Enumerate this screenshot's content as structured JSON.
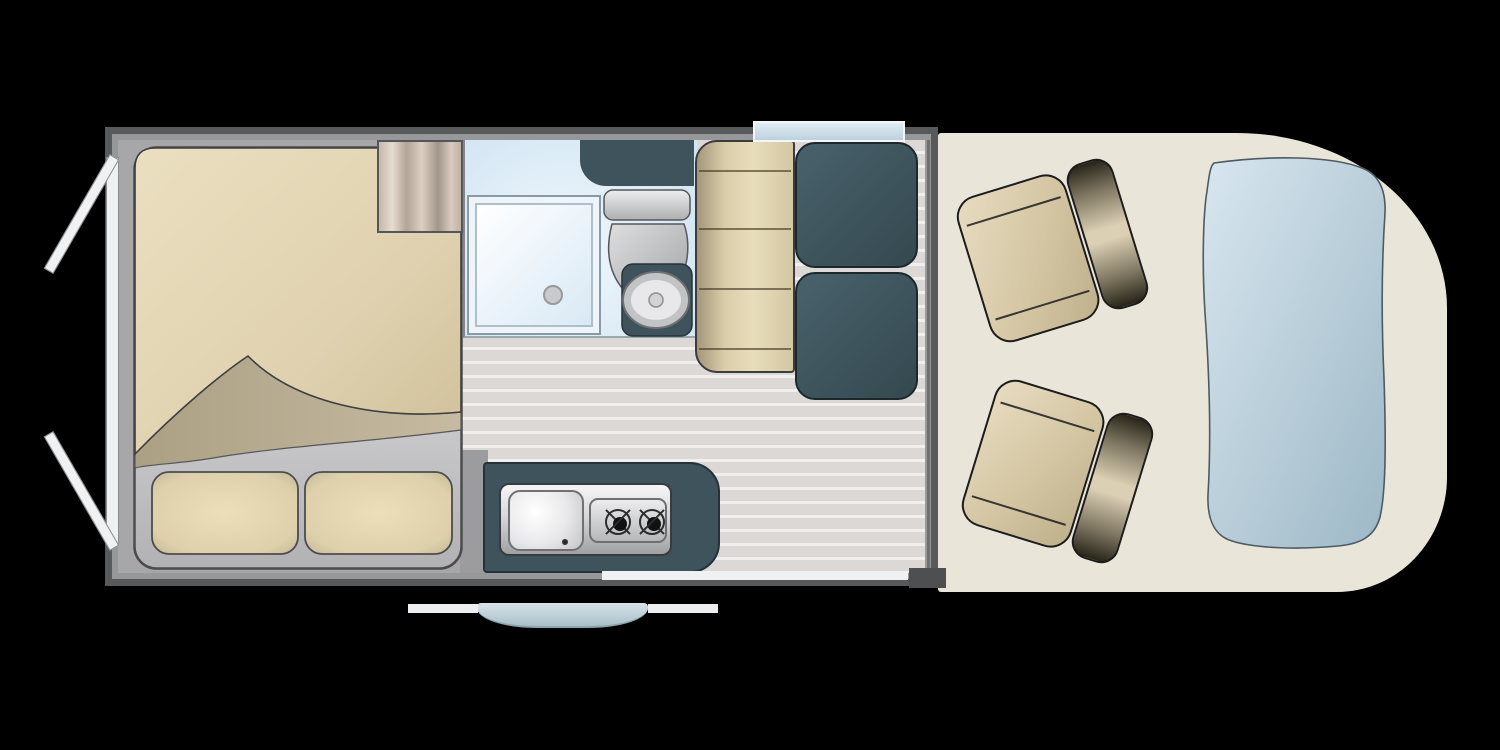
{
  "title": "Campervan floor plan (top view)",
  "palette": {
    "bg": "#000000",
    "wall_dark": "#58595b",
    "wall_light": "#97989a",
    "bedroom_floor": "#a7a7a9",
    "plank_floor": "#dcd8d6",
    "plank_line": "#f1efee",
    "cab_floor": "#e9e6d9",
    "slate": "#3e535b",
    "window_blue": "#c8dbe7",
    "windshield_top": "#d8e6ef",
    "windshield_bottom": "#9db8c6",
    "blanket_tan": "#e2d4b2",
    "blanket_underside": "#b5a98f",
    "seat_tan": "#d8caa9",
    "step_blue": "#c2d4dc",
    "trim_white": "#f0f1f2"
  },
  "layout": {
    "vehicle": "campervan",
    "view": "top-down floor plan",
    "rooms": [
      {
        "name": "rear-bedroom",
        "furniture": [
          "double-bed",
          "pillow",
          "pillow",
          "wardrobe"
        ]
      },
      {
        "name": "bathroom",
        "furniture": [
          "shower-tray",
          "toilet",
          "overhead-cabinet"
        ]
      },
      {
        "name": "dinette",
        "furniture": [
          "bench-backrest",
          "seat-cushion",
          "seat-cushion"
        ]
      },
      {
        "name": "kitchen",
        "furniture": [
          "counter",
          "sink",
          "two-burner-hob"
        ]
      },
      {
        "name": "cab",
        "furniture": [
          "swivel-seat",
          "swivel-seat",
          "windshield"
        ]
      }
    ],
    "openings": [
      "rear-doors-open",
      "sliding-door-entry",
      "dinette-window"
    ],
    "exterior": [
      "entry-step",
      "side-rail",
      "side-rail"
    ]
  }
}
